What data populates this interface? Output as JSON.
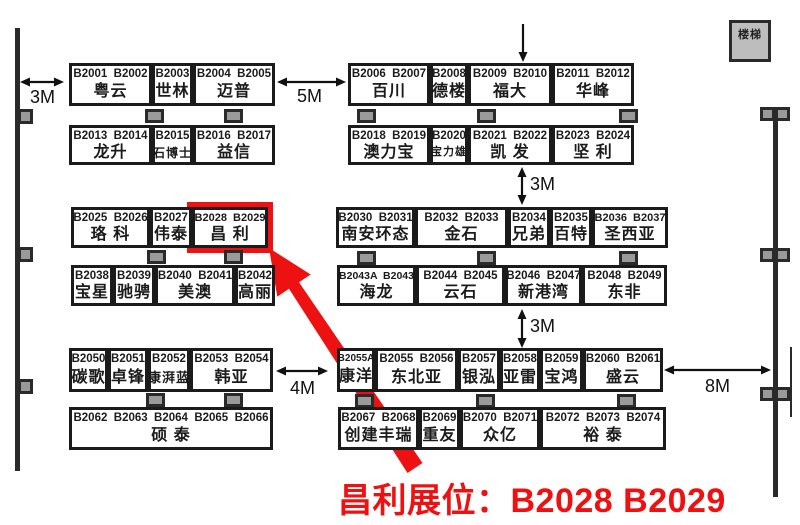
{
  "caption": {
    "text": "昌利展位：B2028 B2029"
  },
  "stairs": {
    "label": "楼梯"
  },
  "colors": {
    "accent": "#ee1111",
    "line": "#1b1b1b",
    "pillar": "#9a9a9a"
  },
  "highlight": {
    "booth_numbers": "B2028 B2029",
    "booth_name": "昌利",
    "rect": {
      "x": 187,
      "y": 202,
      "w": 86,
      "h": 51
    },
    "arrow_points": "269,248 310.7,274.5 299,282.2 422.5,463 407.5,473 289,288.8 277.3,296.6"
  },
  "booth_groups": [
    {
      "x": 69,
      "y": 63,
      "h": 43,
      "booths": [
        {
          "nums": "B2001  B2002",
          "name": "粤云",
          "w": 83
        },
        {
          "nums": "B2003",
          "name": "世林",
          "w": 41
        },
        {
          "nums": "B2004  B2005",
          "name": "迈普",
          "w": 82
        }
      ]
    },
    {
      "x": 348,
      "y": 63,
      "h": 43,
      "booths": [
        {
          "nums": "B2006  B2007",
          "name": "百川",
          "w": 82
        },
        {
          "nums": "B2008",
          "name": "德楼",
          "w": 38
        },
        {
          "nums": "B2009  B2010",
          "name": "福大",
          "w": 84
        },
        {
          "nums": "B2011  B2012",
          "name": "华峰",
          "w": 82
        }
      ]
    },
    {
      "x": 69,
      "y": 125,
      "h": 40,
      "booths": [
        {
          "nums": "B2013  B2014",
          "name": "龙升",
          "w": 83
        },
        {
          "nums": "B2015",
          "name": "石博士",
          "w": 41
        },
        {
          "nums": "B2016  B2017",
          "name": "益信",
          "w": 82
        }
      ]
    },
    {
      "x": 348,
      "y": 125,
      "h": 40,
      "booths": [
        {
          "nums": "B2018  B2019",
          "name": "澳力宝",
          "w": 82
        },
        {
          "nums": "B2020",
          "name": "宝力雄",
          "w": 38
        },
        {
          "nums": "B2021  B2022",
          "name": "凯 发",
          "w": 84
        },
        {
          "nums": "B2023  B2024",
          "name": "坚 利",
          "w": 82
        }
      ]
    },
    {
      "x": 71,
      "y": 207,
      "h": 41,
      "booths": [
        {
          "nums": "B2025  B2026",
          "name": "珞 科",
          "w": 79
        },
        {
          "nums": "B2027",
          "name": "伟泰",
          "w": 42
        },
        {
          "nums": "B2028  B2029",
          "name": "昌 利",
          "w": 76,
          "highlight": true
        }
      ]
    },
    {
      "x": 336,
      "y": 207,
      "h": 41,
      "booths": [
        {
          "nums": "B2030  B2031",
          "name": "南安环态",
          "w": 79
        },
        {
          "nums": "B2032  B2033",
          "name": "金石",
          "w": 93
        },
        {
          "nums": "B2034",
          "name": "兄弟",
          "w": 42
        },
        {
          "nums": "B2035",
          "name": "百特",
          "w": 42
        },
        {
          "nums": "B2036  B2037",
          "name": "圣西亚",
          "w": 76
        }
      ]
    },
    {
      "x": 71,
      "y": 265,
      "h": 41,
      "booths": [
        {
          "nums": "B2038",
          "name": "宝星",
          "w": 42
        },
        {
          "nums": "B2039",
          "name": "驰骋",
          "w": 42
        },
        {
          "nums": "B2040  B2041",
          "name": "美澳",
          "w": 80
        },
        {
          "nums": "B2042",
          "name": "高丽",
          "w": 40
        }
      ]
    },
    {
      "x": 337,
      "y": 265,
      "h": 41,
      "booths": [
        {
          "nums": "B2043A  B2043",
          "name": "海龙",
          "w": 79
        },
        {
          "nums": "B2044  B2045",
          "name": "云石",
          "w": 89
        },
        {
          "nums": "B2046  B2047",
          "name": "新港湾",
          "w": 77
        },
        {
          "nums": "B2048  B2049",
          "name": "东非",
          "w": 85
        }
      ]
    },
    {
      "x": 69,
      "y": 348,
      "h": 44,
      "booths": [
        {
          "nums": "B2050",
          "name": "碳歌",
          "w": 39
        },
        {
          "nums": "B2051",
          "name": "卓锋",
          "w": 40
        },
        {
          "nums": "B2052",
          "name": "康湃蓝",
          "w": 42
        },
        {
          "nums": "B2053  B2054",
          "name": "韩亚",
          "w": 83
        }
      ]
    },
    {
      "x": 337,
      "y": 348,
      "h": 44,
      "booths": [
        {
          "nums": "B2055A",
          "name": "康洋",
          "w": 38
        },
        {
          "nums": "B2055  B2056",
          "name": "东北亚",
          "w": 83
        },
        {
          "nums": "B2057",
          "name": "银泓",
          "w": 42
        },
        {
          "nums": "B2058",
          "name": "亚雷",
          "w": 40
        },
        {
          "nums": "B2059",
          "name": "宝鸿",
          "w": 43
        },
        {
          "nums": "B2060  B2061",
          "name": "盛云",
          "w": 80
        }
      ]
    },
    {
      "x": 69,
      "y": 407,
      "h": 43,
      "booths": [
        {
          "nums": "B2062  B2063  B2064  B2065  B2066",
          "name": "硕 泰",
          "w": 204
        }
      ]
    },
    {
      "x": 338,
      "y": 407,
      "h": 43,
      "booths": [
        {
          "nums": "B2067  B2068",
          "name": "创建丰瑞",
          "w": 81
        },
        {
          "nums": "B2069",
          "name": "重友",
          "w": 41
        },
        {
          "nums": "B2070  B2071",
          "name": "众亿",
          "w": 80
        },
        {
          "nums": "B2072  B2073  B2074",
          "name": "裕 泰",
          "w": 126
        }
      ]
    }
  ],
  "walls": [
    {
      "x": 15,
      "y": 28,
      "w": 5,
      "h": 443
    },
    {
      "x": 773,
      "y": 108,
      "w": 5,
      "h": 389
    },
    {
      "x": 790,
      "y": 347,
      "w": 2,
      "h": 70
    }
  ],
  "pillars": [
    {
      "x": 18,
      "y": 109,
      "w": 15,
      "h": 15
    },
    {
      "x": 18,
      "y": 247,
      "w": 15,
      "h": 15
    },
    {
      "x": 18,
      "y": 379,
      "w": 15,
      "h": 15
    },
    {
      "x": 145,
      "y": 109,
      "w": 19,
      "h": 14
    },
    {
      "x": 224,
      "y": 109,
      "w": 19,
      "h": 14
    },
    {
      "x": 357,
      "y": 109,
      "w": 19,
      "h": 14
    },
    {
      "x": 477,
      "y": 109,
      "w": 19,
      "h": 14
    },
    {
      "x": 619,
      "y": 109,
      "w": 19,
      "h": 14
    },
    {
      "x": 147,
      "y": 250,
      "w": 19,
      "h": 14
    },
    {
      "x": 224,
      "y": 250,
      "w": 19,
      "h": 14
    },
    {
      "x": 357,
      "y": 251,
      "w": 19,
      "h": 14
    },
    {
      "x": 477,
      "y": 251,
      "w": 19,
      "h": 14
    },
    {
      "x": 619,
      "y": 251,
      "w": 19,
      "h": 14
    },
    {
      "x": 146,
      "y": 393,
      "w": 19,
      "h": 14
    },
    {
      "x": 224,
      "y": 393,
      "w": 19,
      "h": 14
    },
    {
      "x": 355,
      "y": 394,
      "w": 19,
      "h": 14
    },
    {
      "x": 476,
      "y": 394,
      "w": 19,
      "h": 14
    },
    {
      "x": 617,
      "y": 394,
      "w": 19,
      "h": 14
    },
    {
      "x": 760,
      "y": 107,
      "w": 15,
      "h": 14
    },
    {
      "x": 775,
      "y": 107,
      "w": 15,
      "h": 14
    },
    {
      "x": 760,
      "y": 248,
      "w": 15,
      "h": 14
    },
    {
      "x": 775,
      "y": 248,
      "w": 15,
      "h": 14
    },
    {
      "x": 760,
      "y": 387,
      "w": 15,
      "h": 14
    },
    {
      "x": 775,
      "y": 387,
      "w": 15,
      "h": 14
    }
  ],
  "arrows": [
    {
      "dir": "h",
      "x1": 20,
      "x2": 64,
      "y": 82,
      "label": "3M",
      "lx": 30,
      "ly": 87
    },
    {
      "dir": "h",
      "x1": 277,
      "x2": 346,
      "y": 82,
      "label": "5M",
      "lx": 297,
      "ly": 86
    },
    {
      "dir": "v1",
      "x": 523,
      "y1": 24,
      "y2": 62,
      "label": "",
      "lx": 0,
      "ly": 0
    },
    {
      "dir": "v",
      "x": 522,
      "y1": 167,
      "y2": 205,
      "label": "3M",
      "lx": 530,
      "ly": 174
    },
    {
      "dir": "v",
      "x": 522,
      "y1": 309,
      "y2": 348,
      "label": "3M",
      "lx": 530,
      "ly": 316
    },
    {
      "dir": "h",
      "x1": 276,
      "x2": 328,
      "y": 371,
      "label": "4M",
      "lx": 290,
      "ly": 378
    },
    {
      "dir": "h",
      "x1": 664,
      "x2": 771,
      "y": 370,
      "label": "8M",
      "lx": 705,
      "ly": 376
    }
  ]
}
